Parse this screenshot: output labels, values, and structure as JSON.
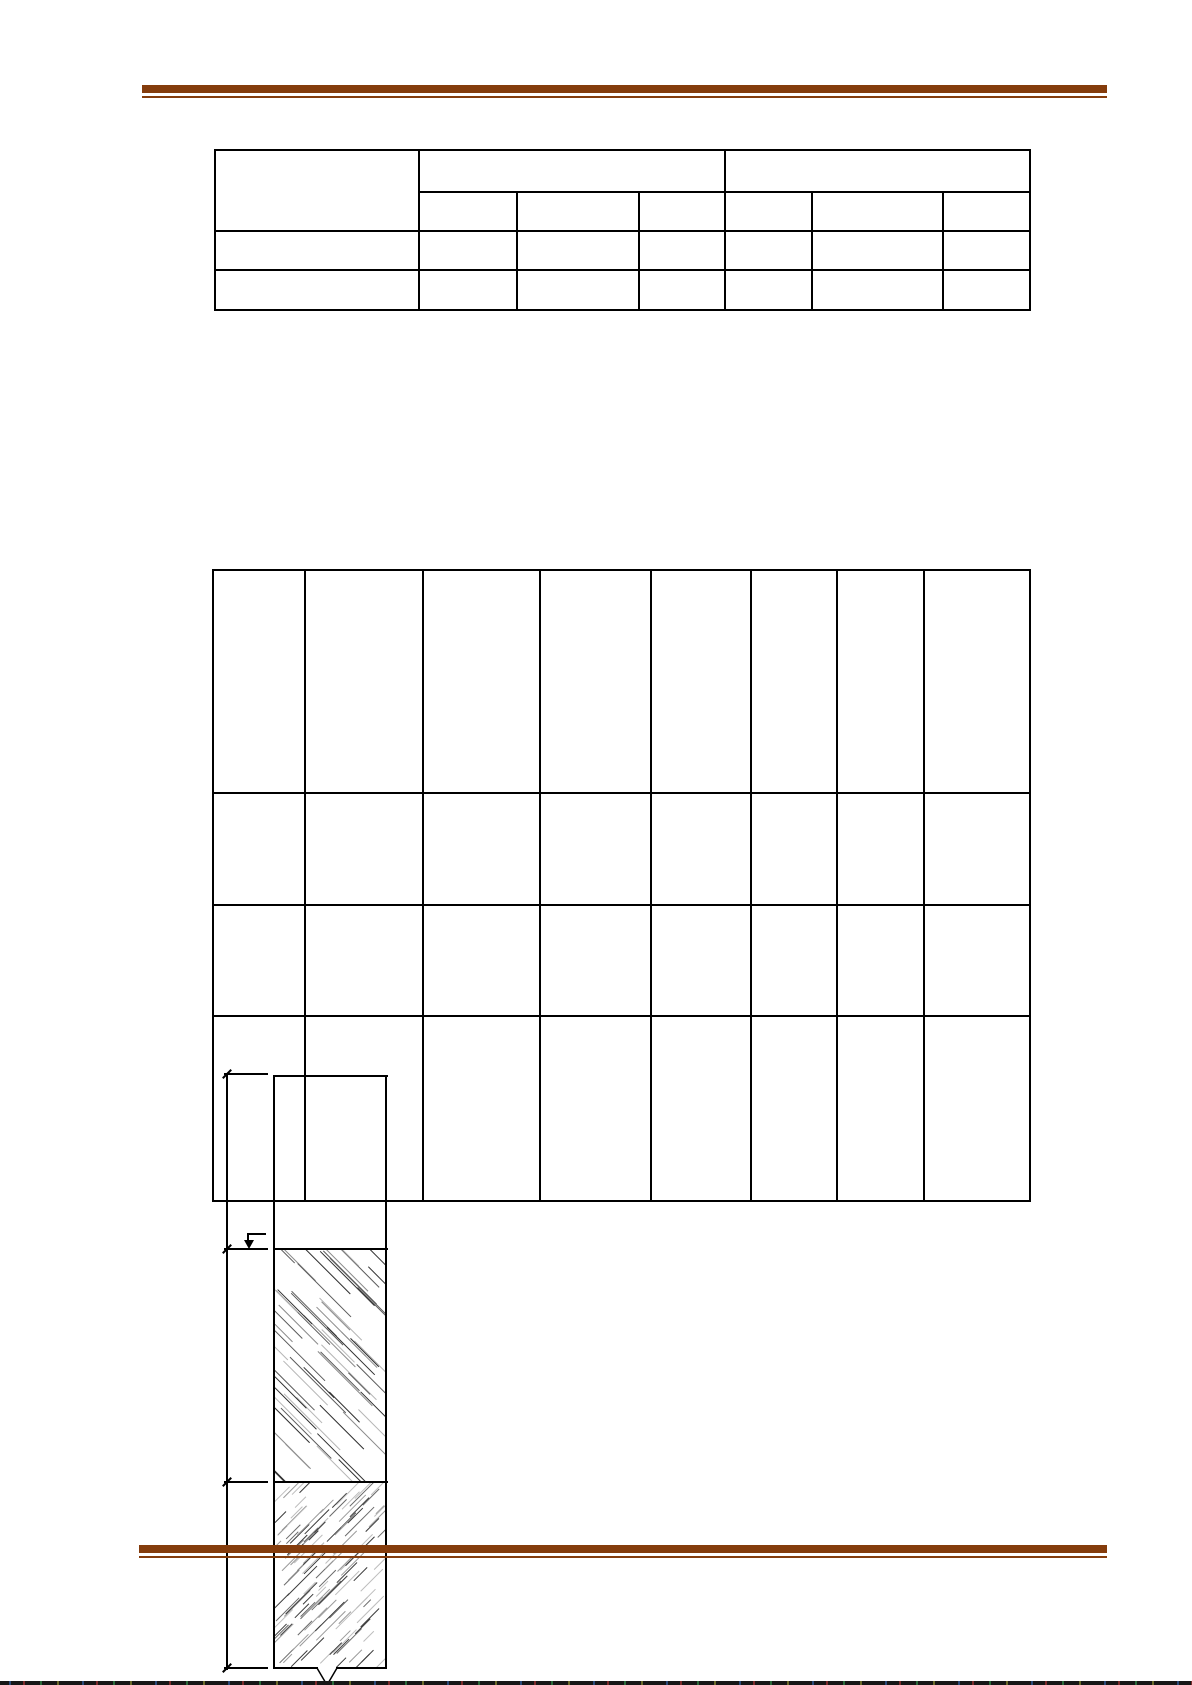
{
  "document": {
    "width": 1192,
    "height": 1685,
    "background": "#ffffff",
    "text_content": ""
  },
  "rules": {
    "color": "#843c0c",
    "top": {
      "x": 142,
      "width": 965,
      "thick_y": 85,
      "thick_h": 8,
      "thin_y": 96,
      "thin_h": 2
    },
    "bottom": {
      "x": 139,
      "width": 968,
      "thick_y": 1545,
      "thick_h": 8,
      "thin_y": 1556,
      "thin_h": 2
    }
  },
  "summary_table": {
    "x": 214,
    "y": 149,
    "col_widths": [
      204,
      98,
      122,
      86,
      87,
      131,
      87
    ],
    "row_heights": [
      42,
      39,
      39,
      40
    ],
    "header_left_rowspan": 2,
    "group_colspans": [
      3,
      3
    ],
    "data_row_count": 2,
    "cells_empty": true
  },
  "main_table": {
    "x": 212,
    "y": 569,
    "col_widths": [
      92,
      118,
      117,
      111,
      100,
      86,
      87,
      106
    ],
    "row_heights": [
      223,
      112,
      111,
      185
    ],
    "cells_empty": true
  },
  "diagram": {
    "line_color": "#000000",
    "dimension_line": {
      "x": 227,
      "y_top": 1074,
      "y_bottom": 1668,
      "tick_ys": [
        1074,
        1249,
        1482,
        1668
      ],
      "dash_x": 224,
      "dash_w": 44
    },
    "soil_column": {
      "left": 273,
      "right": 387,
      "top": 1075,
      "strata_ys": [
        1248,
        1481
      ],
      "bottom": 1667
    },
    "hatch_upper": {
      "direction": "backslash",
      "count": 60,
      "len_min": 30,
      "len_max": 85,
      "stroke_colors": [
        "#2f2f2f",
        "#5a5a5a",
        "#8a8a8a",
        "#b5b5b5"
      ]
    },
    "hatch_lower": {
      "direction": "slash",
      "count": 120,
      "len_min": 10,
      "len_max": 45,
      "stroke_colors": [
        "#3a3a3a",
        "#6a6a6a",
        "#9a9a9a",
        "#bdbdbd"
      ]
    },
    "level_marker": {
      "x": 247,
      "y": 1233,
      "bar_w": 19
    },
    "break_symbol": {
      "x": 310,
      "y": 1666
    }
  },
  "page_edge_strip": {
    "y": 1681,
    "height": 4,
    "base_color": "#161616",
    "speckle_colors": [
      "#2a4a7a",
      "#7a2a2a",
      "#2a6a3a",
      "#6a6a2a"
    ]
  }
}
